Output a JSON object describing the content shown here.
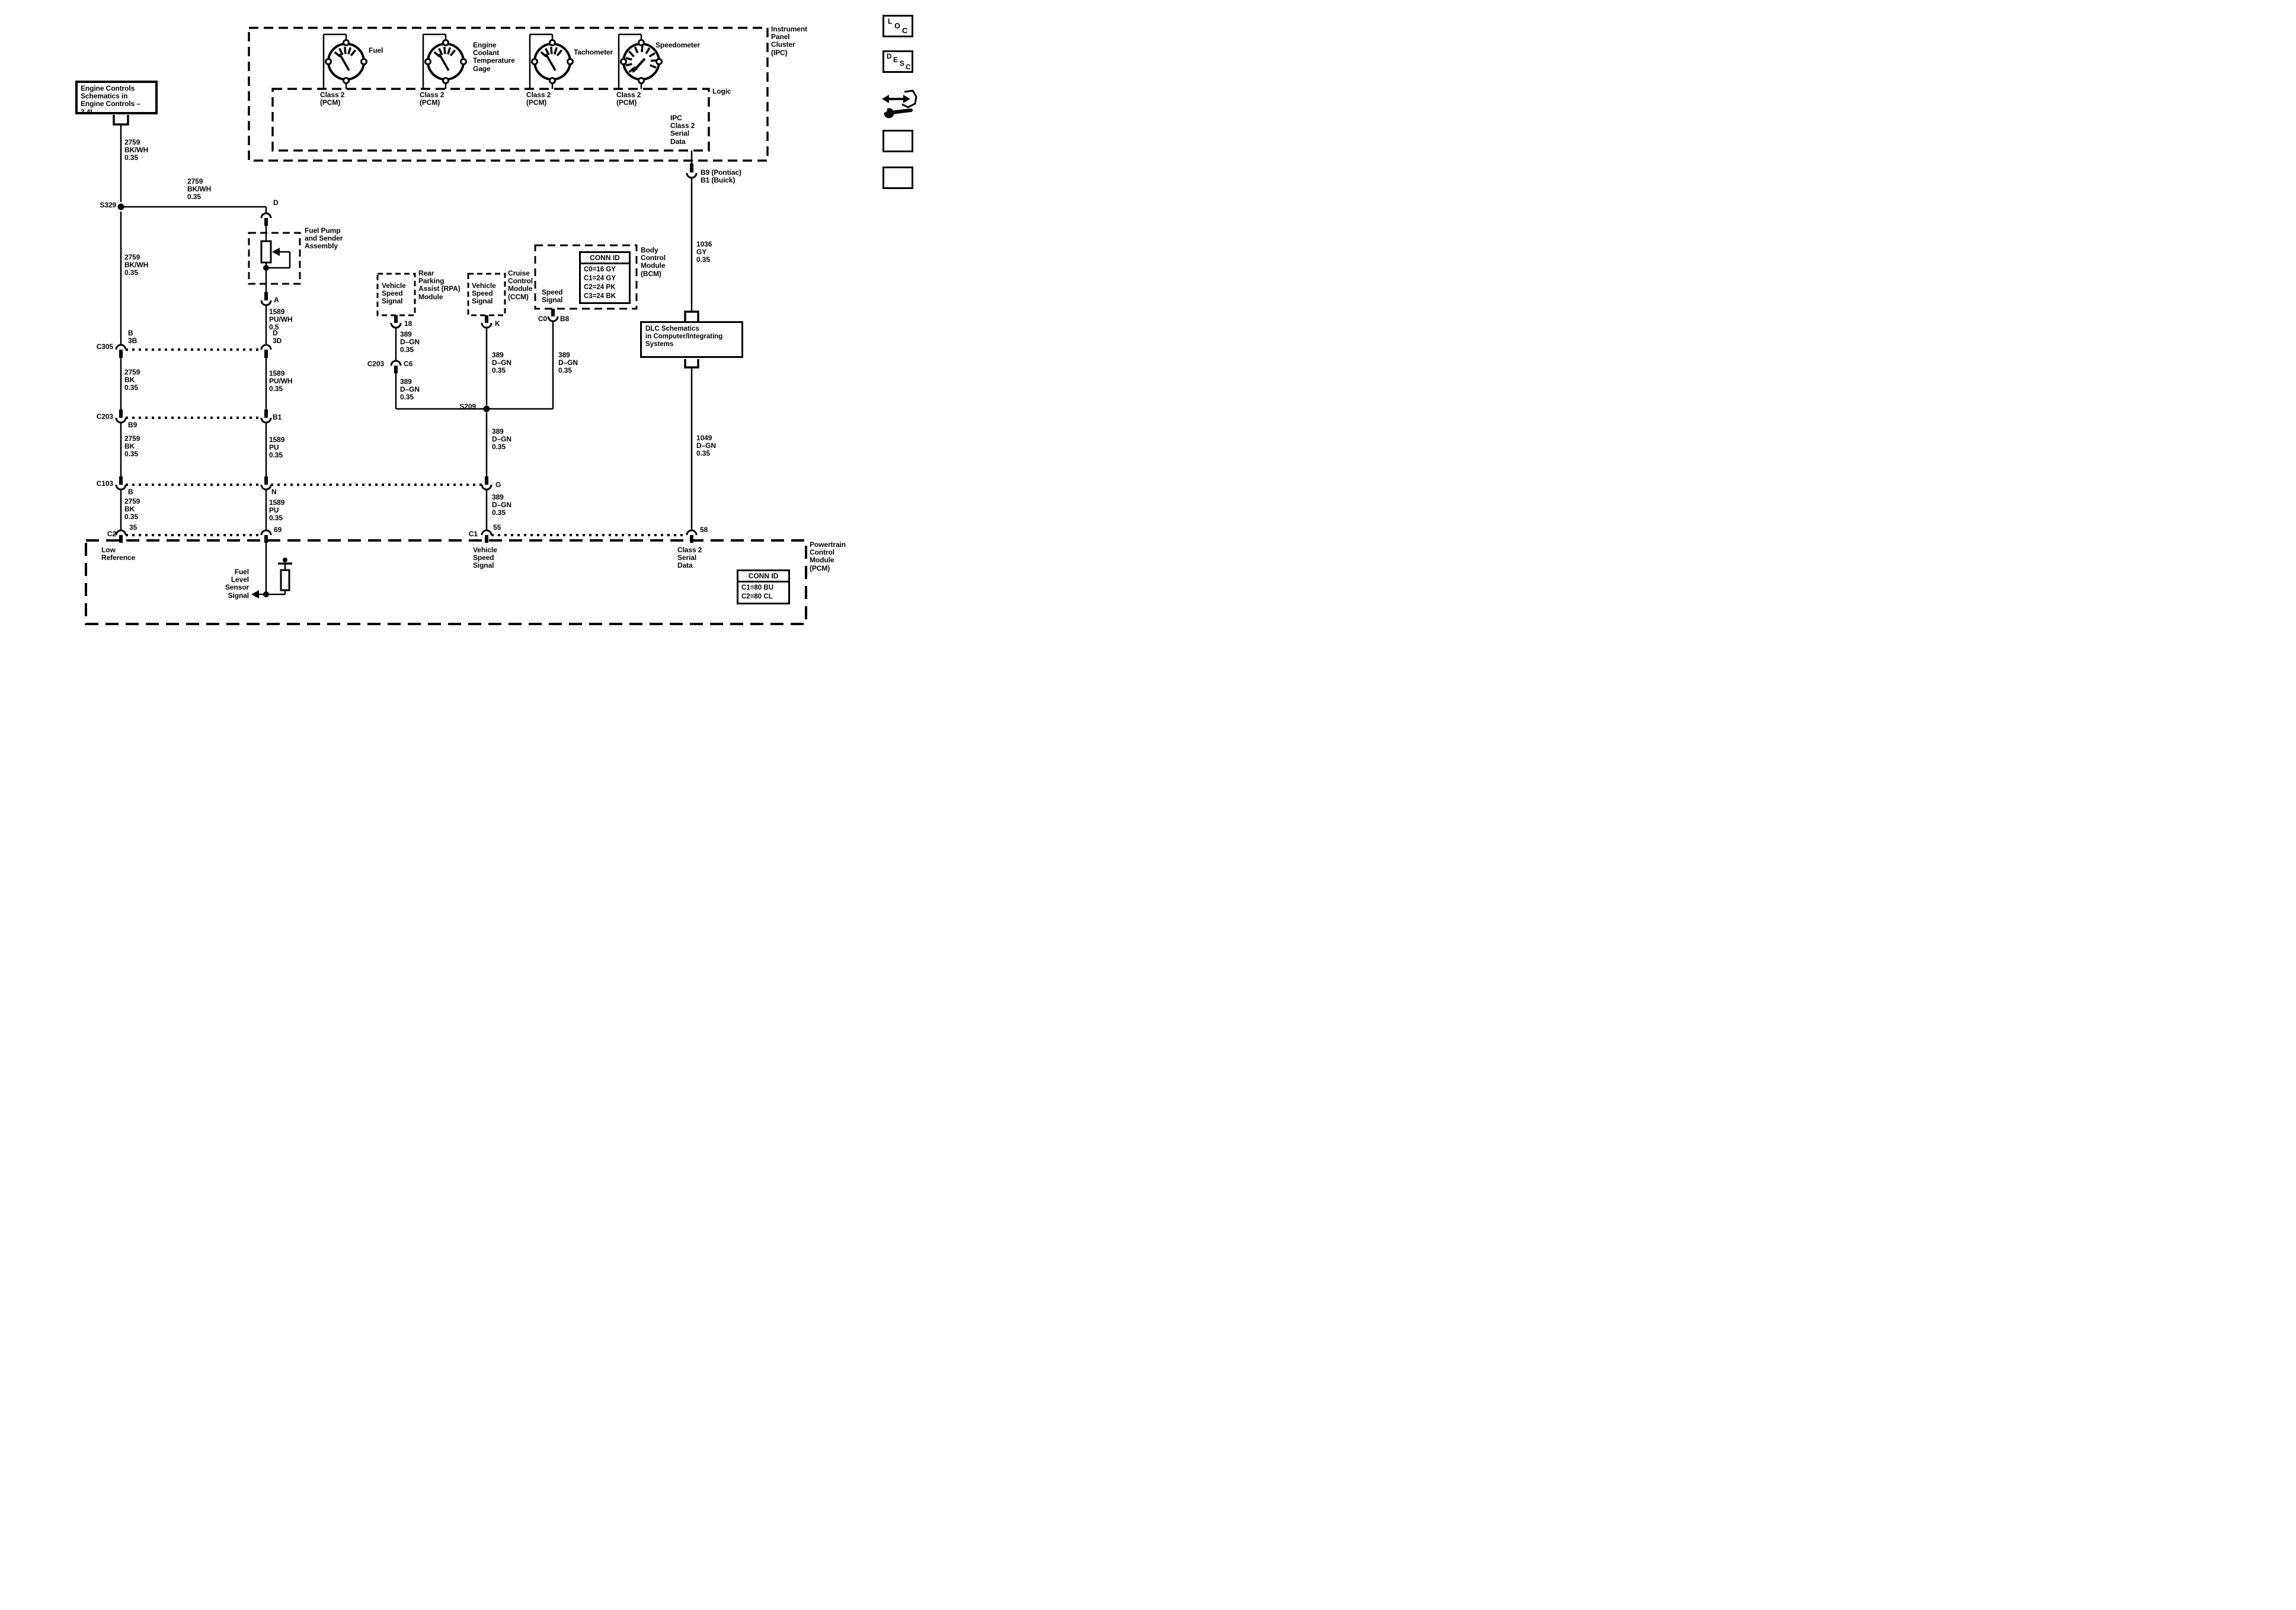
{
  "colors": {
    "ink": "#000000",
    "bg": "#ffffff"
  },
  "labels": {
    "engine_box": "Engine Controls\nSchematics in\nEngine Controls – 3.4L",
    "fuel": "Fuel",
    "ect": "Engine\nCoolant\nTemperature\nGage",
    "tachometer": "Tachometer",
    "speedometer": "Speedometer",
    "class2_pcm": "Class 2\n(PCM)",
    "logic": "Logic",
    "ipc_serial": "IPC\nClass 2\nSerial\nData",
    "ipc_title": "Instrument\nPanel\nCluster\n(IPC)",
    "b9_b1": "B9 (Pontiac)\nB1 (Buick)",
    "s329": "S329",
    "w2759_bkwh": "2759\nBK/WH\n0.35",
    "w2759_bk": "2759\nBK\n0.35",
    "fuel_pump": "Fuel Pump\nand Sender\nAssembly",
    "pin_d": "D",
    "pin_a": "A",
    "w1589_puwh_05": "1589\nPU/WH\n0.5",
    "w1589_puwh": "1589\nPU/WH\n0.35",
    "w1589_pu": "1589\nPU\n0.35",
    "c305": "C305",
    "b_3b": "B\n3B",
    "d_3d": "D\n3D",
    "c203": "C203",
    "pin_b9": "B9",
    "pin_b1": "B1",
    "c103": "C103",
    "pin_b": "B",
    "pin_n": "N",
    "c2": "C2",
    "pin_35": "35",
    "pin_69": "69",
    "vss": "Vehicle\nSpeed\nSignal",
    "rpa": "Rear\nParking\nAssist (RPA)\nModule",
    "ccm": "Cruise\nControl\nModule\n(CCM)",
    "pin_18": "18",
    "pin_k": "K",
    "pin_c0": "C0",
    "pin_b8": "B8",
    "w389": "389\nD–GN\n0.35",
    "c6": "C6",
    "s209": "S209",
    "pin_g": "G",
    "c1": "C1",
    "pin_55": "55",
    "pin_58": "58",
    "speed_signal": "Speed\nSignal",
    "bcm": "Body\nControl\nModule\n(BCM)",
    "conn_id": "CONN ID",
    "bcm_conn_rows": "C0=16 GY\nC1=24 GY\nC2=24 PK\nC3=24 BK",
    "w1036": "1036\nGY\n0.35",
    "dlc": "DLC Schematics\nin Computer/Integrating\nSystems",
    "w1049": "1049\nD–GN\n0.35",
    "pcm": "Powertrain\nControl\nModule\n(PCM)",
    "low_ref": "Low\nReference",
    "class2_serial": "Class 2\nSerial\nData",
    "fuel_level": "Fuel\nLevel\nSensor\nSignal",
    "pcm_conn_rows": "C1=80 BU\nC2=80 CL"
  },
  "icons": {
    "loc": [
      "L",
      "O",
      "C"
    ],
    "desc": [
      "D",
      "E",
      "S",
      "C"
    ]
  }
}
